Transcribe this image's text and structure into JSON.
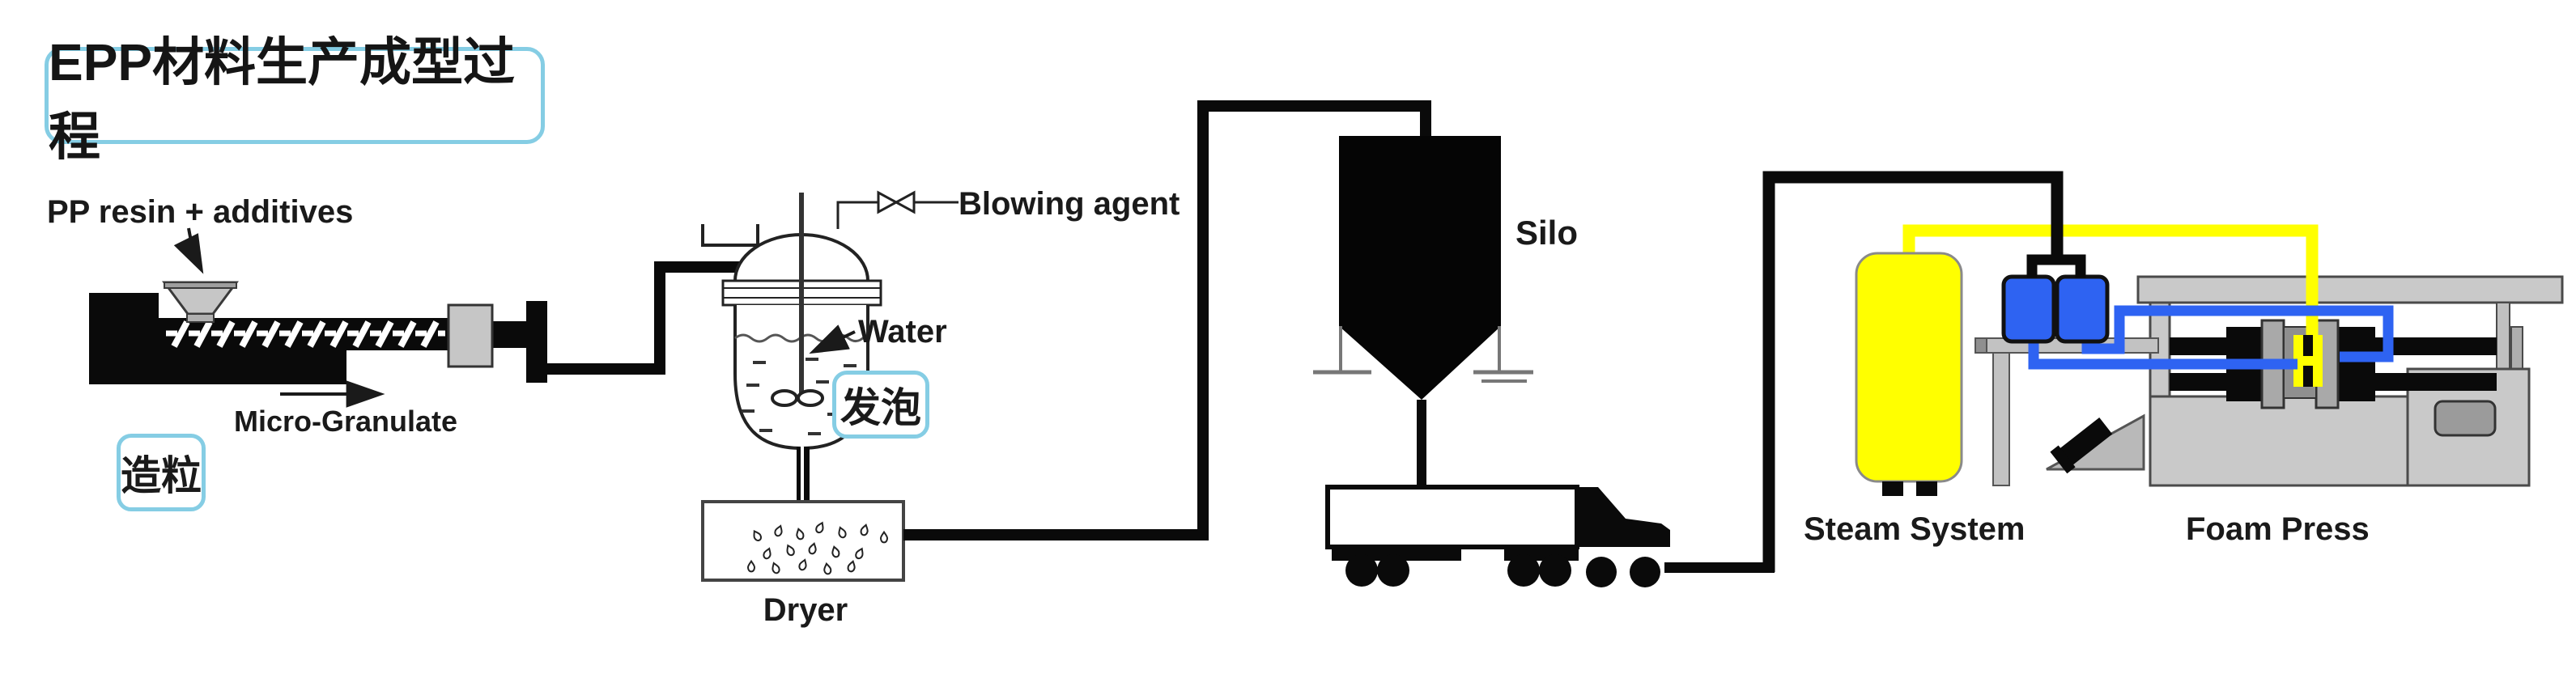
{
  "diagram": {
    "title": "EPP材料生产成型过程",
    "stages": {
      "granulation": "造粒",
      "foaming": "发泡"
    },
    "labels": {
      "pp_resin": "PP resin + additives",
      "micro_granulate": "Micro-Granulate",
      "blowing_agent": "Blowing agent",
      "water": "Water",
      "silo": "Silo",
      "dryer": "Dryer",
      "steam_system": "Steam System",
      "foam_press": "Foam Press"
    },
    "icons": {
      "valve": "bowtie-valve-icon",
      "droplets": "water-droplets-pattern",
      "arrow": "flow-arrow-icon"
    },
    "colors": {
      "accent_border": "#85cde4",
      "ink": "#0a0a0a",
      "steam_yellow": "#ffff00",
      "pipe_blue": "#2e63f2",
      "machine_gray": "#c9c9c9",
      "dark_gray": "#8f8f8f"
    }
  }
}
